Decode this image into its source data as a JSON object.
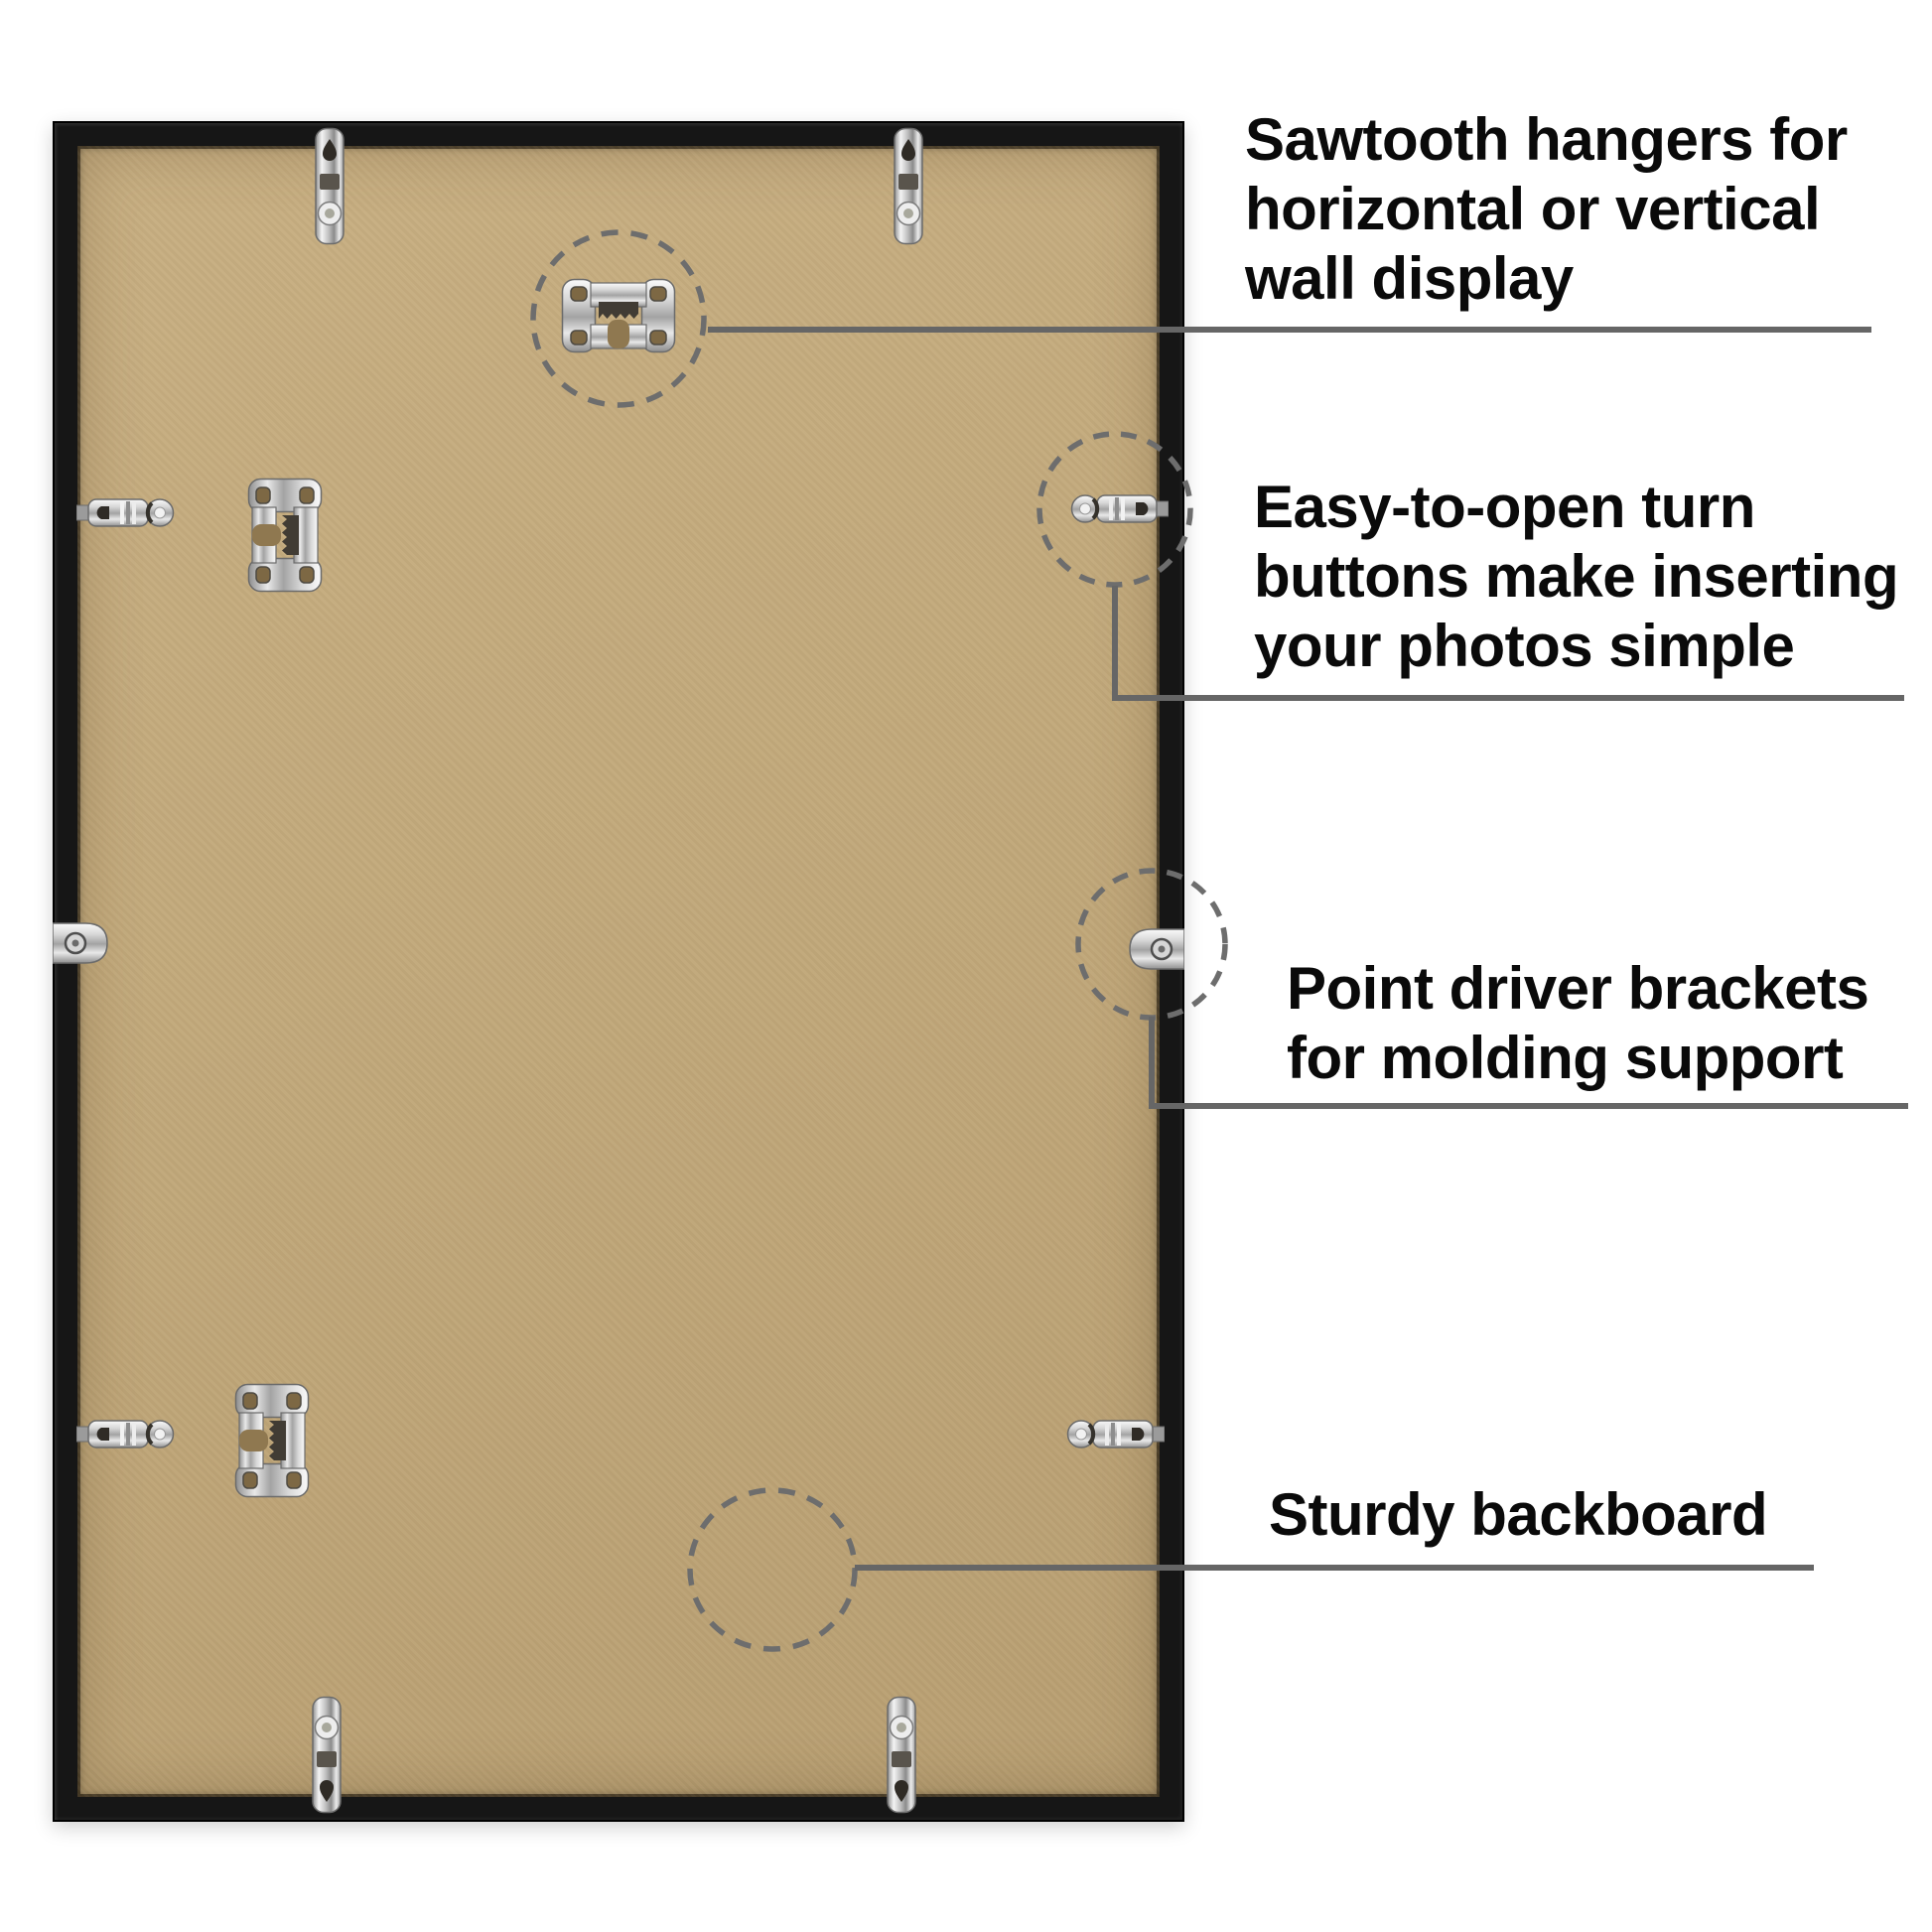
{
  "page": {
    "background_color": "#ffffff"
  },
  "colors": {
    "frame_black": "#161616",
    "backboard_tan": "#c2a97b",
    "connector_gray": "#666666",
    "dash_circle_gray": "#6d6d6d",
    "text_black": "#0a0a0a",
    "hardware_silver": "#d9d9d9"
  },
  "hardware": {
    "sawtooth_hanger": "sawtooth-hanger-icon",
    "turn_button": "turn-button-icon",
    "turn_button_clip": "turn-button-clip-icon",
    "point_driver_bracket": "point-driver-bracket-icon",
    "backboard": "backboard"
  },
  "callouts": [
    {
      "id": "sawtooth-hangers",
      "lines": [
        "Sawtooth hangers for",
        "horizontal or vertical",
        "wall display"
      ]
    },
    {
      "id": "turn-buttons",
      "lines": [
        "Easy-to-open turn",
        "buttons make inserting",
        "your photos simple"
      ]
    },
    {
      "id": "point-driver-brackets",
      "lines": [
        "Point driver brackets",
        "for molding support"
      ]
    },
    {
      "id": "sturdy-backboard",
      "lines": [
        "Sturdy backboard"
      ]
    }
  ]
}
